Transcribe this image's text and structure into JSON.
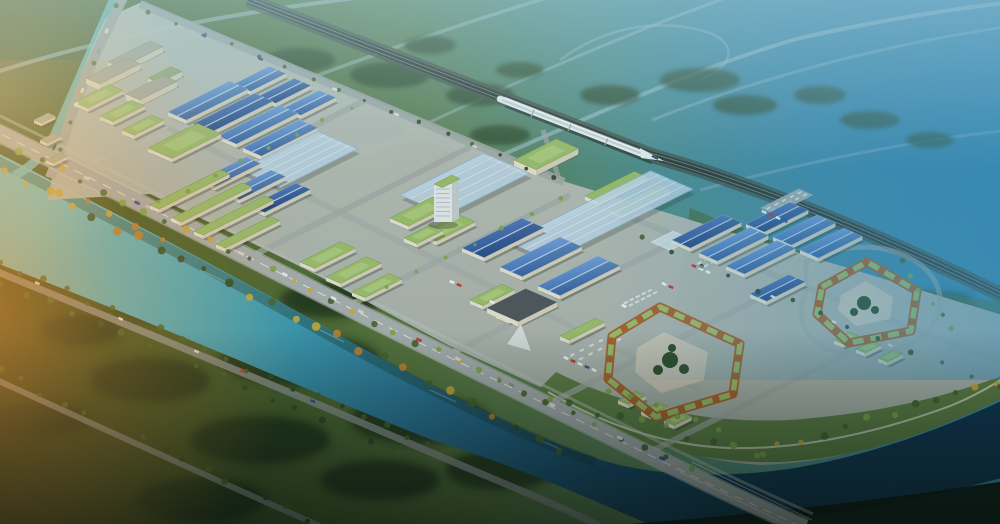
{
  "meta": {
    "scene_type": "aerial-architectural-rendering",
    "subject": "industrial logistics park with river, railway and bullet train",
    "visible_text": "none"
  },
  "palette": {
    "bg0": "#243318",
    "bg1": "#3f5524",
    "bg2": "#55703a",
    "bg3": "#5d8259",
    "bg4": "#4f8e8e",
    "bg5": "#3f89a9",
    "bg6": "#2b7aa9",
    "rv0": "#6cc3cd",
    "rv1": "#42a0b4",
    "rv2": "#2a7396",
    "rv3": "#17486b",
    "rv4": "#0f3350",
    "roofBlueA": "#7fa9de",
    "roofBlueB": "#3f6fb4",
    "roofSolarA": "#5d83c2",
    "roofSolarB": "#2c5494",
    "roofRidge": "#bcd3ee",
    "glass": "#c3dcee",
    "glassEdge": "#8fb4d2",
    "atrium": "#dcebf5",
    "roofGreen": "#9cbd6b",
    "roofGreenLight": "#b8d488",
    "roofGreenDark": "#7a9c4e",
    "wallCream": "#e6e0cf",
    "wallDark": "#d6cfbc",
    "wallGray": "#a8a89e",
    "clusterRoof": "#93ab7c",
    "darkBldg": "#50555a",
    "notch": "#d8dcde",
    "plaza": "#cdc7b6",
    "ringWall": "#a9612c",
    "parking": "#adb3b1",
    "parkDash": "#e6e9e8",
    "platformA": "#c2c6c0",
    "platformB": "#a8aea8",
    "grassEast": "#4c6a38",
    "promenade": "#5a7a3e",
    "walk": "#d7dacb",
    "roadMain": "#a8aeae",
    "roadEdge": "#c9cdcb",
    "roadMinor": "#a2a8a6",
    "roadSouth": "#8b928e",
    "roadDistant": "#a8c3ce",
    "dash": "#f3f3ef",
    "bridgeRail": "#e3e6e4",
    "railEmbank": "#46544a",
    "railDark": "#2d3531",
    "railLight": "#7c8d85",
    "train": "#eef4f6",
    "trainStripe": "#c3ced4",
    "trainShadow": "#10201a",
    "trainGap": "#93a5ae",
    "windshield": "#2c3e4a",
    "tB": "#7da445",
    "tM": "#44632c",
    "tD": "#2e4a22",
    "tY": "#c9a93c",
    "tO": "#c07f2e",
    "tFar": "#2b4526",
    "tS": "#1d3117",
    "flareA": "#ff9c38",
    "flareB": "#ffd794",
    "hazeTop": "#aed3dc",
    "hazeRight": "#3f93c0",
    "shadeBottom": "#07110c",
    "tint": "#1d5e6e",
    "shadow": "#1a2418",
    "reflection": "#17372a",
    "sparkle": "#bfe6ea",
    "darkBank": "#0a130e",
    "carColors": [
      "#e8eaec",
      "#c23b32",
      "#2e4f8c",
      "#d8d8d4",
      "#8a9096",
      "#e8eaec"
    ],
    "truckW": "#f2f4f4",
    "truckR": "#c0392b",
    "truckB": "#2f5b8f",
    "towerFace": "#e4e8ea",
    "towerSide": "#c4cbd0",
    "towerLine": "#aab6bd"
  },
  "scene": {
    "river": {
      "path": "M -12,148 C 90,200 210,262 330,330 C 440,392 530,436 595,458 C 655,478 730,478 795,468 C 872,455 945,428 1012,396 L 1012,475 C 930,498 850,514 760,521 L 648,524 C 575,492 505,462 432,440 C 310,392 150,320 -12,260 Z",
      "reflection": "M -12,156 C 90,208 210,268 330,336 C 440,396 530,440 595,462",
      "canal": "M 116,-6 C 96,40 76,86 56,132 C 48,150 36,164 14,176",
      "sparkles": [
        [
          200,
          270,
          30,
          14
        ],
        [
          320,
          330,
          24,
          12
        ],
        [
          430,
          390,
          26,
          12
        ],
        [
          540,
          440,
          22,
          10
        ]
      ]
    },
    "darkBank": "M 630,524 C 760,514 880,500 1012,480 L 1012,524 Z",
    "grassEast": "M 690,208 C 800,252 910,298 1012,302 L 1012,390 C 940,424 876,442 800,450 C 742,428 700,396 668,364 Z",
    "platform": "M 48,200 C 58,142 78,72 106,18 L 142,2 L 566,182 L 1012,318 L 1012,392 C 918,440 838,462 762,465 C 700,462 640,440 600,414 L 450,346 L 300,266 L 150,194 Z",
    "promenade": {
      "path": "M 530,398 C 620,442 700,464 780,462 C 870,458 945,426 1012,394 L 1012,372 C 940,400 870,414 790,420 C 700,424 620,404 556,372 Z",
      "walk": "M 548,392 C 610,428 670,446 730,448 C 800,450 880,432 950,406 C 975,396 995,384 1010,374"
    },
    "railway": {
      "path": "M 248,0 L 650,155 C 760,186 890,240 1012,300"
    },
    "train": {
      "body": "M 500,99 L 645,155",
      "stripe": "M 502,100 L 643,154",
      "shadow": "M 505,106 L 652,163",
      "glint": "M 505,97.5 L 640,151",
      "nose": "640,148 664,161 641,158",
      "windshield": "M 652,156 L 658,159",
      "gaps": [
        [
          534,
          110,
          531,
          117
        ],
        [
          571,
          124,
          568,
          131
        ],
        [
          608,
          138,
          605,
          145
        ]
      ]
    },
    "distantRoads": [
      {
        "d": "M -10,74 C 110,36 230,12 390,-6",
        "w": 4,
        "o": 0.6
      },
      {
        "d": "M 60,175 C 230,108 400,40 580,-12",
        "w": 3.5,
        "o": 0.5
      },
      {
        "d": "M 250,205 C 430,122 600,40 760,-14",
        "w": 3,
        "o": 0.45
      },
      {
        "d": "M 428,187 C 540,140 680,72 800,38 C 890,18 960,8 1012,2",
        "w": 4,
        "o": 0.6
      },
      {
        "d": "M 652,120 C 780,70 900,42 1012,26",
        "w": 3,
        "o": 0.4
      },
      {
        "d": "M 700,190 C 850,150 960,135 1012,130",
        "w": 3,
        "o": 0.35
      },
      {
        "d": "M 560,60 C 600,30 650,18 700,30 C 740,40 736,66 700,80",
        "w": 2.5,
        "o": 0.4
      }
    ],
    "minorRoads": [
      {
        "d": "M 140,4 C 280,62 420,122 564,182",
        "w": 8,
        "o": 0.9
      },
      {
        "d": "M 126,-8 C 100,42 78,92 64,138 C 58,156 54,168 50,178",
        "w": 10,
        "o": 1
      },
      {
        "d": "M 168,128 C 330,208 520,300 700,390",
        "w": 6,
        "o": 0.5
      },
      {
        "d": "M 600,205 C 740,262 880,318 1012,365",
        "w": 6,
        "o": 0.6
      },
      {
        "d": "M 150,208 L 370,98",
        "w": 6,
        "o": 0.75
      },
      {
        "d": "M 250,257 L 470,147",
        "w": 6,
        "o": 0.75
      },
      {
        "d": "M 350,305 L 570,195",
        "w": 6,
        "o": 0.75
      },
      {
        "d": "M 450,354 L 670,244",
        "w": 6,
        "o": 0.75
      },
      {
        "d": "M 550,403 L 770,293",
        "w": 6,
        "o": 0.75
      },
      {
        "d": "M 650,452 L 870,342",
        "w": 6,
        "o": 0.75
      },
      {
        "d": "M 560,182 L 543,130",
        "w": 5,
        "o": 0.7
      },
      {
        "d": "M 806,262 C 840,244 880,242 910,258 C 940,274 948,302 932,326 C 914,350 872,360 836,352 C 806,344 794,318 806,292 Z",
        "w": 5,
        "o": 0.6
      }
    ],
    "southRoads": [
      {
        "d": "M -12,268 C 140,330 300,396 430,452 C 500,482 560,506 600,526",
        "w": 7,
        "o": 0.85
      },
      {
        "d": "M -12,376 C 110,432 220,482 320,526",
        "w": 6,
        "o": 0.8
      }
    ],
    "mainRoad": {
      "path": "M -12,128 C 150,206 330,300 500,382 C 640,450 710,486 805,528",
      "sidewalk": "M -4,114 C 158,192 338,286 508,368 C 648,436 718,472 813,514",
      "bridgeRails": [
        "M 692,462 L 812,520",
        "M 680,472 L 798,530"
      ]
    },
    "parking": [
      [
        560,
        354,
        54,
        26
      ],
      [
        690,
        262,
        40,
        20
      ],
      [
        760,
        208,
        44,
        16
      ],
      [
        618,
        302,
        34,
        16
      ]
    ],
    "buildings": [
      [
        "clu",
        108,
        62,
        48,
        14
      ],
      [
        "clu",
        148,
        78,
        26,
        12
      ],
      [
        "clu",
        86,
        78,
        46,
        15
      ],
      [
        "grn",
        74,
        102,
        40,
        15
      ],
      [
        "clu",
        126,
        94,
        42,
        15
      ],
      [
        "grn",
        100,
        116,
        36,
        14
      ],
      [
        "grn",
        122,
        130,
        34,
        13
      ],
      [
        "shp",
        34,
        120,
        16,
        8
      ],
      [
        "shp",
        40,
        140,
        16,
        8
      ],
      [
        "shp",
        46,
        160,
        16,
        8
      ],
      [
        "wh",
        234,
        84,
        40,
        18
      ],
      [
        "wh",
        259,
        96,
        40,
        18
      ],
      [
        "wh",
        284,
        108,
        40,
        18
      ],
      [
        "wh",
        168,
        112,
        70,
        20
      ],
      [
        "wh",
        193,
        124,
        70,
        20
      ],
      [
        "wh",
        218,
        136,
        70,
        20
      ],
      [
        "wh",
        243,
        148,
        64,
        20
      ],
      [
        "grn",
        148,
        148,
        56,
        26
      ],
      [
        "gl",
        240,
        170,
        88,
        44
      ],
      [
        "gl",
        400,
        195,
        95,
        50
      ],
      [
        "sta",
        514,
        160,
        48,
        24
      ],
      [
        "grs",
        585,
        196,
        56,
        14
      ],
      [
        "grs",
        610,
        210,
        56,
        12
      ],
      [
        "gl",
        508,
        242,
        162,
        46
      ],
      [
        "atr",
        652,
        242,
        24,
        20
      ],
      [
        "grn",
        390,
        218,
        48,
        20
      ],
      [
        "grn",
        420,
        234,
        44,
        18
      ],
      [
        "wh",
        200,
        180,
        52,
        16
      ],
      [
        "wh",
        225,
        193,
        52,
        16
      ],
      [
        "wh",
        250,
        206,
        52,
        16
      ],
      [
        "grs",
        150,
        205,
        80,
        10
      ],
      [
        "grs",
        172,
        218,
        80,
        10
      ],
      [
        "grs",
        194,
        231,
        80,
        10
      ],
      [
        "grs",
        216,
        244,
        62,
        10
      ],
      [
        "grn",
        300,
        262,
        46,
        16
      ],
      [
        "grn",
        326,
        277,
        46,
        16
      ],
      [
        "grn",
        352,
        292,
        42,
        14
      ],
      [
        "grn",
        404,
        238,
        30,
        14
      ],
      [
        "wh",
        462,
        248,
        68,
        24
      ],
      [
        "wh",
        500,
        267,
        68,
        24
      ],
      [
        "wh",
        538,
        286,
        68,
        24
      ],
      [
        "grn",
        470,
        300,
        36,
        14
      ],
      [
        "grn",
        496,
        314,
        36,
        14
      ],
      [
        "grs",
        560,
        336,
        40,
        10
      ],
      [
        "wh",
        746,
        224,
        50,
        20
      ],
      [
        "wh",
        773,
        237,
        50,
        20
      ],
      [
        "wh",
        800,
        250,
        50,
        20
      ],
      [
        "wh",
        672,
        240,
        58,
        20
      ],
      [
        "wh",
        699,
        253,
        58,
        20
      ],
      [
        "wh",
        726,
        266,
        58,
        20
      ],
      [
        "wh",
        750,
        294,
        44,
        18
      ],
      [
        "drk",
        487,
        308,
        44,
        34
      ],
      [
        "grn",
        618,
        400,
        20,
        11
      ],
      [
        "grn",
        641,
        411,
        20,
        11
      ],
      [
        "grn",
        664,
        421,
        20,
        11
      ],
      [
        "grn",
        834,
        340,
        18,
        10
      ],
      [
        "grn",
        856,
        349,
        18,
        10
      ],
      [
        "grn",
        878,
        358,
        18,
        10
      ]
    ],
    "darkNotch": "507,344 531,351 521,324",
    "courtyards": [
      {
        "outer": "M 612,336 L 660,307 L 740,344 L 733,394 L 656,417 L 608,379 Z",
        "plaza": "637,348 664,332 708,352 704,380 661,393 635,372",
        "trees": [
          [
            670,
            360,
            8
          ],
          [
            658,
            370,
            5
          ],
          [
            684,
            369,
            5
          ],
          [
            672,
            348,
            4
          ]
        ]
      },
      {
        "outer": "M 822,287 L 867,262 L 917,291 L 911,331 L 849,343 L 817,314 Z",
        "plaza": "841,295 866,281 893,297 890,319 856,326 838,310",
        "trees": [
          [
            864,
            303,
            7
          ],
          [
            854,
            312,
            4
          ],
          [
            875,
            310,
            4
          ]
        ]
      }
    ],
    "tower": {
      "face": [
        434,
        184,
        18,
        38
      ],
      "side": "452,184 459,180.5 459,218.5 452,222",
      "roof": [
        434,
        184,
        20,
        9
      ],
      "shadow": [
        443,
        225,
        15,
        4
      ],
      "lines": [
        436,
        450,
        189,
        4.5,
        7
      ]
    },
    "treeMassesFar": [
      [
        210,
        45,
        28,
        10
      ],
      [
        300,
        60,
        35,
        12
      ],
      [
        390,
        75,
        40,
        13
      ],
      [
        255,
        95,
        30,
        10
      ],
      [
        430,
        45,
        26,
        9
      ],
      [
        480,
        95,
        34,
        11
      ],
      [
        520,
        70,
        24,
        8
      ],
      [
        610,
        95,
        30,
        10
      ],
      [
        700,
        80,
        40,
        12
      ],
      [
        745,
        105,
        32,
        10
      ],
      [
        820,
        95,
        26,
        9
      ],
      [
        360,
        130,
        45,
        14
      ],
      [
        300,
        150,
        38,
        12
      ],
      [
        420,
        155,
        40,
        12
      ],
      [
        500,
        135,
        30,
        10
      ],
      [
        870,
        120,
        30,
        9
      ],
      [
        930,
        140,
        24,
        8
      ]
    ],
    "treeMassesSouth": [
      [
        90,
        260,
        55,
        20
      ],
      [
        180,
        300,
        70,
        24
      ],
      [
        300,
        360,
        80,
        26
      ],
      [
        420,
        420,
        70,
        24
      ],
      [
        150,
        380,
        60,
        22
      ],
      [
        260,
        440,
        70,
        24
      ],
      [
        80,
        330,
        40,
        16
      ],
      [
        380,
        480,
        60,
        20
      ],
      [
        500,
        470,
        55,
        20
      ],
      [
        40,
        420,
        50,
        18
      ],
      [
        200,
        500,
        65,
        22
      ],
      [
        330,
        300,
        50,
        18
      ]
    ],
    "treeMassesEast": [
      [
        885,
        332,
        40,
        12
      ],
      [
        940,
        302,
        34,
        10
      ],
      [
        975,
        345,
        30,
        10
      ],
      [
        850,
        368,
        34,
        10
      ]
    ],
    "treeLines": [
      [
        20,
        150,
        500,
        382,
        24,
        2,
        4,
        [
          "tB",
          "tM",
          "tY"
        ],
        3,
        1
      ],
      [
        500,
        382,
        690,
        470,
        9,
        2,
        3.5,
        [
          "tB",
          "tM"
        ],
        3,
        2
      ],
      [
        5,
        172,
        560,
        448,
        26,
        2.5,
        4.5,
        [
          "tM",
          "tD",
          "tY",
          "tO"
        ],
        4,
        3
      ],
      [
        0,
        262,
        430,
        446,
        20,
        2,
        3.5,
        [
          "tD",
          "tM"
        ],
        3,
        4
      ],
      [
        0,
        282,
        420,
        462,
        18,
        2,
        3.5,
        [
          "tD",
          "tM"
        ],
        3,
        5
      ],
      [
        0,
        372,
        310,
        518,
        16,
        2,
        3.5,
        [
          "tD",
          "tM"
        ],
        4,
        6
      ],
      [
        548,
        400,
        760,
        452,
        10,
        2.5,
        4,
        [
          "tB",
          "tM"
        ],
        5,
        7
      ],
      [
        760,
        452,
        1000,
        382,
        12,
        2.5,
        4,
        [
          "tB",
          "tM",
          "tY"
        ],
        5,
        8
      ],
      [
        640,
        240,
        1000,
        388,
        13,
        2,
        3,
        [
          "tM",
          "tD"
        ],
        3,
        9
      ],
      [
        900,
        262,
        950,
        330,
        6,
        2,
        3,
        [
          "tM",
          "tB"
        ],
        3,
        10
      ],
      [
        150,
        12,
        555,
        178,
        16,
        1.5,
        2.5,
        [
          "tD",
          "tM"
        ],
        2,
        11
      ],
      [
        360,
        300,
        560,
        200,
        8,
        1.5,
        2.5,
        [
          "tB"
        ],
        2,
        12
      ],
      [
        160,
        203,
        350,
        108,
        8,
        1.5,
        2.5,
        [
          "tB"
        ],
        2,
        13
      ],
      [
        118,
        6,
        60,
        150,
        6,
        2,
        3,
        [
          "tM",
          "tY"
        ],
        3,
        14
      ],
      [
        610,
        390,
        720,
        430,
        6,
        2,
        3,
        [
          "tB"
        ],
        3,
        15
      ],
      [
        60,
        190,
        160,
        240,
        5,
        2.5,
        4,
        [
          "tY",
          "tO"
        ],
        3,
        16
      ]
    ],
    "carLines": [
      [
        70,
        170,
        690,
        472,
        13,
        6,
        3,
        21
      ],
      [
        30,
        280,
        380,
        430,
        5,
        5,
        2.5,
        22
      ],
      [
        112,
        18,
        66,
        130,
        4,
        5,
        3,
        23
      ],
      [
        190,
        30,
        520,
        165,
        5,
        5,
        2.5,
        24
      ],
      [
        660,
        250,
        950,
        370,
        4,
        5,
        2.5,
        25
      ]
    ],
    "trucks": [
      [
        566,
        358,
        "w"
      ],
      [
        573,
        361,
        "r"
      ],
      [
        580,
        364,
        "w"
      ],
      [
        587,
        367,
        "b"
      ],
      [
        594,
        370,
        "w"
      ],
      [
        694,
        266,
        "r"
      ],
      [
        701,
        269,
        "w"
      ],
      [
        708,
        272,
        "w"
      ],
      [
        764,
        212,
        "w"
      ],
      [
        771,
        215,
        "r"
      ],
      [
        778,
        218,
        "w"
      ],
      [
        785,
        221,
        "b"
      ],
      [
        452,
        282,
        "w"
      ],
      [
        459,
        285,
        "r"
      ],
      [
        492,
        302,
        "w"
      ],
      [
        664,
        284,
        "w"
      ],
      [
        671,
        287,
        "r"
      ],
      [
        624,
        306,
        "w"
      ]
    ]
  }
}
